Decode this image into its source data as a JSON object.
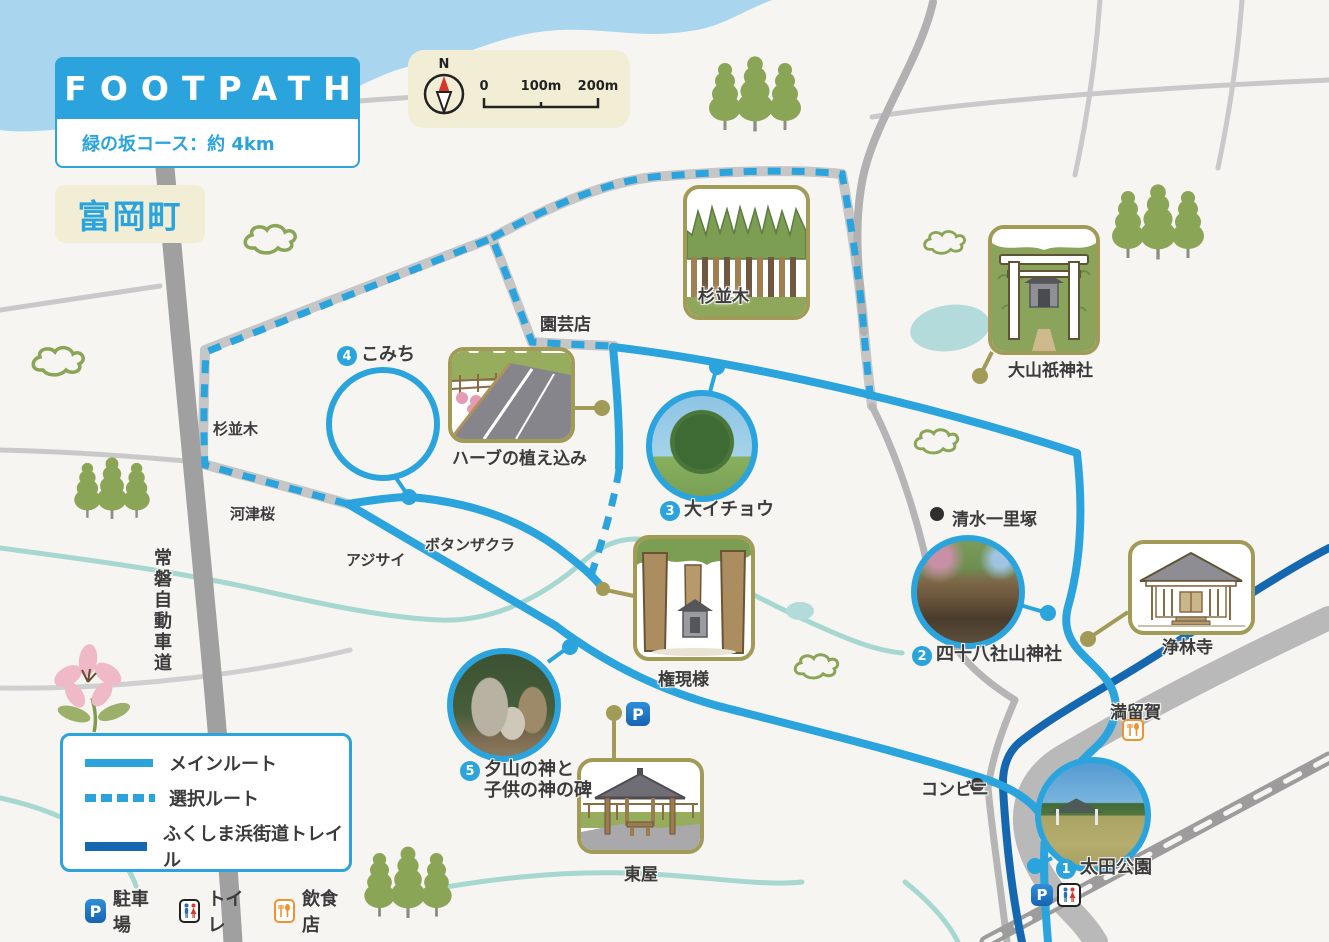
{
  "header": {
    "title": "FOOTPATH",
    "course": "緑の坂コース：約 4km",
    "town": "富岡町"
  },
  "compass": {
    "north": "N",
    "scale": [
      "0",
      "100m",
      "200m"
    ]
  },
  "legend": {
    "main_route": "メインルート",
    "optional_route": "選択ルート",
    "trail": "ふくしま浜街道トレイル",
    "parking": "駐車場",
    "toilet": "トイレ",
    "restaurant": "飲食店",
    "parking_symbol": "P"
  },
  "pois": [
    {
      "num": "1",
      "label": "太田公園"
    },
    {
      "num": "2",
      "label": "四十八社山神社"
    },
    {
      "num": "3",
      "label": "大イチョウ"
    },
    {
      "num": "4",
      "label": "こみち"
    },
    {
      "num": "5",
      "label": "夕山の神と",
      "label2": "子供の神の碑"
    }
  ],
  "landmarks": {
    "suginamiki_top": "杉並木",
    "suginamiki_left": "杉並木",
    "engeiten": "園芸店",
    "oyamazumi": "大山祇神社",
    "herb": "ハーブの植え込み",
    "kawazuzakura": "河津桜",
    "ajisai": "アジサイ",
    "botanzakura": "ボタンザクラ",
    "gongensama": "権現様",
    "shimizu_ichirizuka": "清水一里塚",
    "jorinji": "浄林寺",
    "maruka": "満留賀",
    "konbini": "コンビニ",
    "azumaya": "東屋",
    "joban_expressway": "常磐自動車道"
  },
  "colors": {
    "route_blue": "#2ba4dd",
    "trail_blue": "#1568b0",
    "road_gray": "#ababab",
    "cream": "#f2eed6",
    "olive": "#a29b58",
    "water": "#a9d5ee",
    "creek": "#a7d7d1",
    "tree_green": "#8ba556",
    "parking_blue": "#1d6fc0",
    "restaurant_orange": "#ef9232"
  }
}
